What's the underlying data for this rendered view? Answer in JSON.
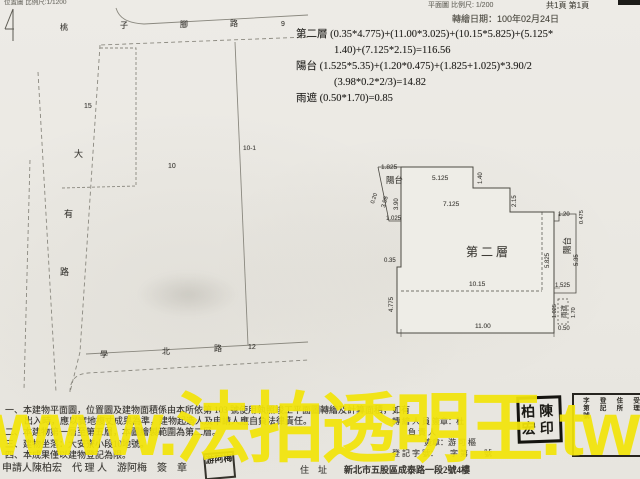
{
  "header": {
    "site_plan_scale": "位置圖 比例尺:1/1200",
    "floor_plan_scale": "平面圖 比例尺: 1/200",
    "page_indicator": "共1頁 第1頁",
    "transcribe_date": "轉繪日期：100年02月24日"
  },
  "watermark": "www.法拍透明王.tw",
  "colors": {
    "watermark": "#f2e40a",
    "paper": "#ebe9e3",
    "ink": "#3e3c37"
  },
  "calculations": {
    "rows": [
      {
        "t": "第二層 (0.35*4.775)+(11.00*3.025)+(10.15*5.825)+(5.125*",
        "x": 296,
        "y": 30
      },
      {
        "t": "1.40)+(7.125*2.15)=116.56",
        "x": 334,
        "y": 46
      },
      {
        "t": "陽台 (1.525*5.35)+(1.20*0.475)+(1.825+1.025)*3.90/2",
        "x": 296,
        "y": 62
      },
      {
        "t": "(3.98*0.2*2/3)=14.82",
        "x": 334,
        "y": 78
      },
      {
        "t": "雨遮 (0.50*1.70)=0.85",
        "x": 296,
        "y": 94
      }
    ]
  },
  "site_plan": {
    "labels": [
      {
        "t": "桃",
        "x": 60,
        "y": 24,
        "s": 8
      },
      {
        "t": "子",
        "x": 120,
        "y": 22,
        "s": 8
      },
      {
        "t": "腳",
        "x": 180,
        "y": 21,
        "s": 8
      },
      {
        "t": "路",
        "x": 230,
        "y": 20,
        "s": 8
      },
      {
        "t": "9",
        "x": 281,
        "y": 21,
        "s": 7
      },
      {
        "t": "15",
        "x": 84,
        "y": 103,
        "s": 7
      },
      {
        "t": "10",
        "x": 168,
        "y": 163,
        "s": 7
      },
      {
        "t": "10-1",
        "x": 243,
        "y": 146,
        "s": 6.5
      },
      {
        "t": "大",
        "x": 74,
        "y": 150,
        "s": 9
      },
      {
        "t": "有",
        "x": 64,
        "y": 210,
        "s": 9
      },
      {
        "t": "路",
        "x": 60,
        "y": 268,
        "s": 9
      },
      {
        "t": "學",
        "x": 100,
        "y": 351,
        "s": 8
      },
      {
        "t": "北",
        "x": 162,
        "y": 348,
        "s": 8
      },
      {
        "t": "路",
        "x": 214,
        "y": 345,
        "s": 8
      },
      {
        "t": "12",
        "x": 248,
        "y": 344,
        "s": 7
      }
    ]
  },
  "floor_plan": {
    "labels": [
      {
        "t": "1.825",
        "x": 381,
        "y": 165,
        "s": 6.5
      },
      {
        "t": "陽台",
        "x": 386,
        "y": 176,
        "s": 8.5,
        "n": "balcony-left-label"
      },
      {
        "t": "0.20",
        "x": 371,
        "y": 203,
        "r": -72,
        "s": 5.5
      },
      {
        "t": "3.98",
        "x": 381,
        "y": 207,
        "r": -75,
        "s": 6
      },
      {
        "t": "3.90",
        "x": 394,
        "y": 210,
        "r": -90,
        "s": 6
      },
      {
        "t": "1.025",
        "x": 386,
        "y": 216,
        "s": 6
      },
      {
        "t": "5.125",
        "x": 432,
        "y": 176,
        "s": 6.5
      },
      {
        "t": "1.40",
        "x": 478,
        "y": 184,
        "r": -90,
        "s": 6
      },
      {
        "t": "7.125",
        "x": 443,
        "y": 202,
        "s": 6.5
      },
      {
        "t": "2.15",
        "x": 512,
        "y": 207,
        "r": -90,
        "s": 6
      },
      {
        "t": "0.35",
        "x": 384,
        "y": 258,
        "s": 6
      },
      {
        "t": "4.775",
        "x": 389,
        "y": 312,
        "r": -90,
        "s": 6
      },
      {
        "t": "第二層",
        "x": 466,
        "y": 246,
        "s": 12,
        "n": "room-label"
      },
      {
        "t": "10.15",
        "x": 469,
        "y": 282,
        "s": 6.5
      },
      {
        "t": "11.00",
        "x": 475,
        "y": 324,
        "s": 6.5
      },
      {
        "t": "5.825",
        "x": 545,
        "y": 268,
        "r": -90,
        "s": 6
      },
      {
        "t": "1.20",
        "x": 558,
        "y": 212,
        "s": 6
      },
      {
        "t": "0.475",
        "x": 580,
        "y": 224,
        "r": -90,
        "s": 5.5
      },
      {
        "t": "陽台",
        "x": 563,
        "y": 254,
        "r": -90,
        "s": 8.5,
        "n": "balcony-right-label"
      },
      {
        "t": "5.35",
        "x": 574,
        "y": 266,
        "r": -90,
        "s": 6
      },
      {
        "t": "1.525",
        "x": 555,
        "y": 283,
        "s": 6
      },
      {
        "t": "1.025",
        "x": 553,
        "y": 318,
        "r": -90,
        "s": 5.5
      },
      {
        "t": "雨遮",
        "x": 562,
        "y": 318,
        "r": -90,
        "s": 6.5,
        "n": "canopy-label"
      },
      {
        "t": "1.70",
        "x": 572,
        "y": 318,
        "r": -90,
        "s": 5.5
      },
      {
        "t": "0.50",
        "x": 558,
        "y": 326,
        "s": 6
      }
    ]
  },
  "notes": {
    "lines": [
      {
        "t": "一、本建物平面圖，位置圖及建物面積係由本所依第 103 號使用執照竣工平面圖轉繪及計算面積，如有",
        "x": 5,
        "y": 406
      },
      {
        "t": "出入時，應以實地複丈成果為準，建物起造人及申請人應自負法律責任。",
        "x": 24,
        "y": 417
      },
      {
        "t": "二、本建物第一層至第五層，本圖繪製範圍為第二層。",
        "x": 5,
        "y": 428
      },
      {
        "t": "三、建物坐落：大安寮小段10地號。",
        "x": 5,
        "y": 440
      },
      {
        "t": "四、本成果僅以建物登記為限。",
        "x": 5,
        "y": 451
      }
    ]
  },
  "signature_block": {
    "rows": [
      {
        "t": "轉 繪 人 員 簽章：杜",
        "x": 392,
        "y": 418
      },
      {
        "t": "負 責 人",
        "x": 408,
        "y": 429
      },
      {
        "t": "簽章：游 可 樞",
        "x": 424,
        "y": 439
      },
      {
        "t": "登 記 字 號：　　字 第　　號",
        "x": 392,
        "y": 450
      }
    ]
  },
  "footer": {
    "applicant_line": "申請人陳柏宏　代 理 人　游阿梅　簽　章",
    "address_label": "住　址",
    "address": "新北市五股區成泰路一段2號4樓"
  },
  "stamps": {
    "agent_seal": "游阿梅",
    "applicant_seal_lines": [
      "柏陳",
      "宏印"
    ],
    "registration_seal_columns": [
      "受理",
      "住所",
      "登記",
      "字第號"
    ]
  }
}
